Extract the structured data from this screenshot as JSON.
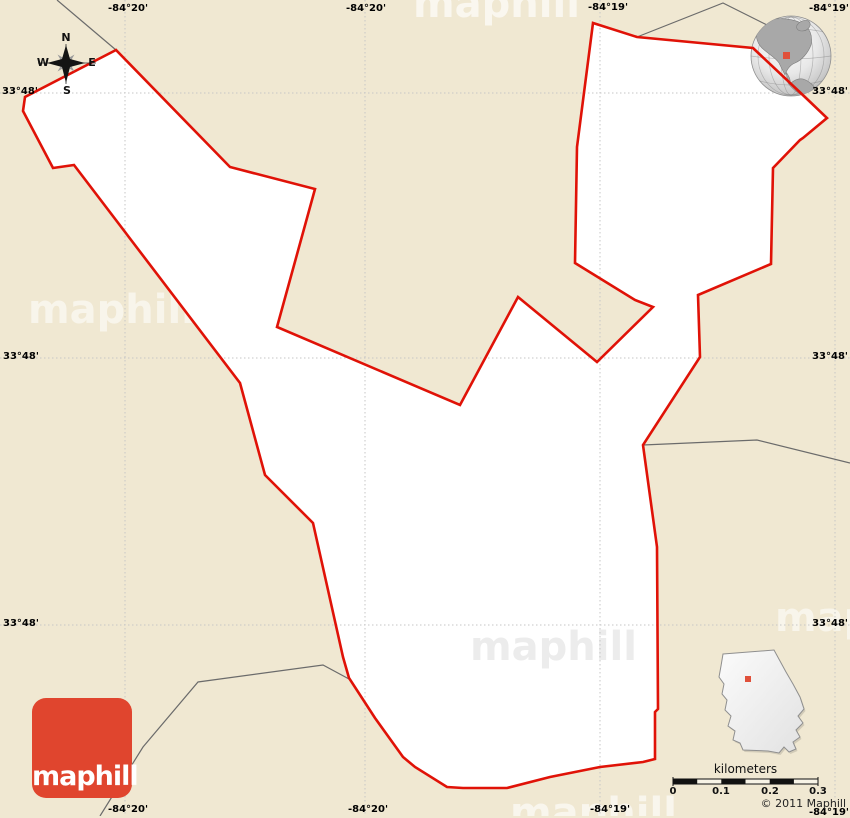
{
  "colors": {
    "background": "#f0e8d2",
    "region_fill": "#ffffff",
    "boundary_red": "#e01207",
    "road_gray": "#6b6b6b",
    "gridline_gray": "#c6c6c6",
    "logo_red": "#e0452e",
    "logo_text": "#ffffff",
    "marker_red": "#e0503a",
    "inset_fill": "#f2f2f2",
    "inset_stroke": "#8f8f8f",
    "watermark_on_white": "#ececec"
  },
  "grid_labels": {
    "top": [
      "-84°20'",
      "-84°20'",
      "-84°19'",
      "-84°19'"
    ],
    "bottom": [
      "-84°20'",
      "-84°20'",
      "-84°19'",
      "-84°19'"
    ],
    "left": [
      "33°48'",
      "33°48'",
      "33°48'"
    ],
    "right": [
      "33°48'",
      "33°48'",
      "33°48'"
    ]
  },
  "compass": {
    "north": "N",
    "south": "S",
    "east": "E",
    "west": "W"
  },
  "scalebar": {
    "title": "kilometers",
    "tick_labels": [
      "0",
      "0.1",
      "0.2",
      "0.3"
    ]
  },
  "copyright": {
    "text": "© 2011 Maphill"
  },
  "logo": {
    "text": "maphill"
  },
  "watermark": {
    "text": "maphill"
  },
  "geometry": {
    "boundary": "116,50 25,97 23,111 53,168 74,165 240,383 265,475 313,523 343,657 349,678 375,718 403,757 415,767 447,787 463,788 507,788 550,777 600,767 643,762 655,759 655,712 658,709 657,547 643,445 700,357 698,295 771,264 773,168 800,140 803,138 827,118 806,98 753,48 637,37 593,23 577,147 575,263 635,300 653,307 597,362 518,297 460,405 277,327 315,189 230,167",
    "road_topleft": "57,0 116,50",
    "road_topright": "637,37 723,3 767,25 795,42",
    "road_right": "643,445 757,440 850,463",
    "road_bottomleft": "100,816 143,747 198,682 323,665 349,679",
    "georgia_outline": "723,654 774,650 780,661 786,672 793,684 800,697 804,709 798,716 803,723 796,730 800,737 793,742 796,749 789,752 784,747 779,753 768,751 743,750 740,743 733,740 735,731 728,726 731,716 725,710 727,700 722,694 724,684 719,677 721,666",
    "gridlines_x": [
      125,
      365,
      600,
      835
    ],
    "gridlines_y": [
      93,
      358,
      625
    ]
  }
}
